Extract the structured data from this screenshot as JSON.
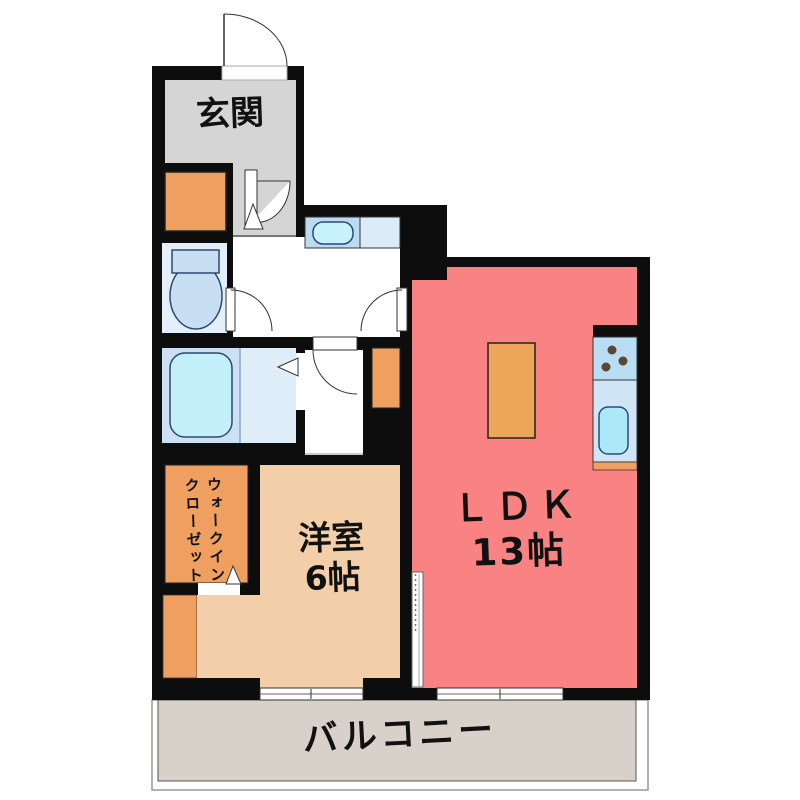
{
  "rooms": {
    "genkan": {
      "label": "玄関"
    },
    "ldk": {
      "label": "ＬＤＫ",
      "size": "13帖"
    },
    "bedroom": {
      "label": "洋室",
      "size": "6帖"
    },
    "wic": {
      "label_line1": "ウォークイン",
      "label_line2": "クローゼット"
    },
    "balcony": {
      "label": "バルコニー"
    }
  },
  "colors": {
    "wall": "#0d0d0d",
    "genkan_floor": "#d5d5d6",
    "closet_orange": "#efa060",
    "ldk_red": "#f98282",
    "bedroom_tan": "#f2cfa9",
    "balcony_gray": "#d8d1c9",
    "fixture_blue": "#cfe5f6",
    "tub_cyan": "#c3eff8",
    "table_orange": "#eda559"
  }
}
